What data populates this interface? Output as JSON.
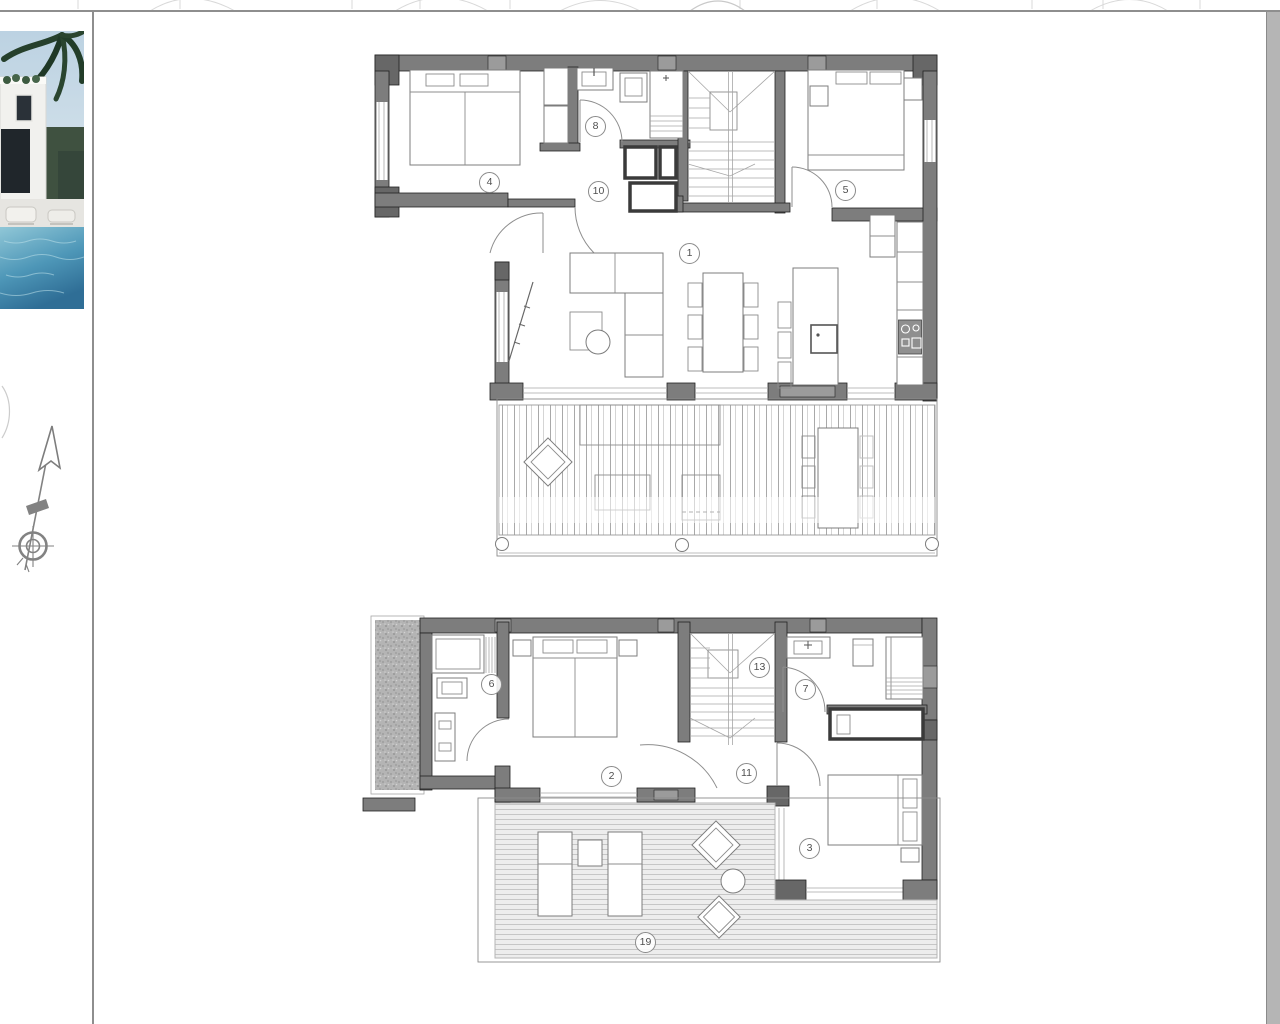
{
  "document": {
    "visible_text": [
      "1",
      "2",
      "3",
      "4",
      "5",
      "6",
      "7",
      "8",
      "10",
      "11",
      "13",
      "19"
    ]
  },
  "colors": {
    "wall": "#7d7d7d",
    "wall_dark": "#676767",
    "wall_light": "#9b9b9b",
    "wall_stroke": "#222222",
    "furniture": "#7c7c7c",
    "thin_line": "#a6a6a6",
    "arc": "#8e8e8e",
    "deck_line": "#c6c6c6",
    "label": "#4f4f4f",
    "divider": "#8e8e8e",
    "scrollbar_strip": "#b5b5b5",
    "pool": "#3a7fa3",
    "hatch": "#b4b4b4"
  },
  "sidebar": {
    "photo": {
      "name": "villa-photo"
    },
    "compass": {
      "name": "north-arrow"
    }
  },
  "floor_plans": {
    "upper": {
      "room_labels": [
        {
          "number": "1",
          "x": 690,
          "y": 254
        },
        {
          "number": "4",
          "x": 490,
          "y": 183
        },
        {
          "number": "8",
          "x": 596,
          "y": 127
        },
        {
          "number": "10",
          "x": 599,
          "y": 192
        },
        {
          "number": "5",
          "x": 846,
          "y": 191
        }
      ]
    },
    "lower": {
      "room_labels": [
        {
          "number": "6",
          "x": 492,
          "y": 685
        },
        {
          "number": "2",
          "x": 612,
          "y": 777
        },
        {
          "number": "13",
          "x": 760,
          "y": 668
        },
        {
          "number": "7",
          "x": 806,
          "y": 690
        },
        {
          "number": "11",
          "x": 747,
          "y": 774
        },
        {
          "number": "3",
          "x": 810,
          "y": 849
        },
        {
          "number": "19",
          "x": 646,
          "y": 943
        }
      ]
    }
  }
}
